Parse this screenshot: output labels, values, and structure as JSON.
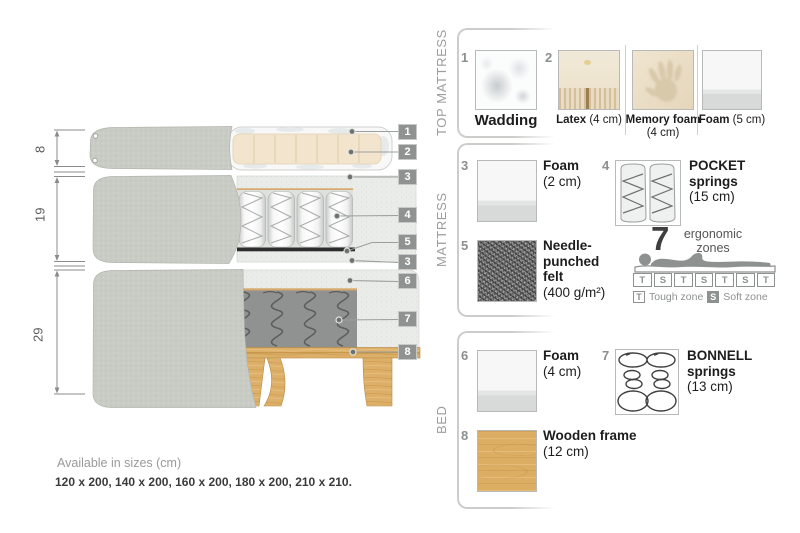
{
  "measurements": {
    "top": "8",
    "middle": "19",
    "bottom": "29"
  },
  "callouts": {
    "c1": "1",
    "c2": "2",
    "c3a": "3",
    "c4": "4",
    "c5": "5",
    "c3b": "3",
    "c6": "6",
    "c7": "7",
    "c8": "8"
  },
  "footer": {
    "title": "Available in sizes (cm)",
    "sizes": "120 x 200, 140 x 200, 160 x 200, 180 x 200, 210 x 210."
  },
  "panel": {
    "sections": {
      "top_mattress": {
        "title": "TOP MATTRESS"
      },
      "mattress": {
        "title": "MATTRESS"
      },
      "bed": {
        "title": "BED"
      }
    },
    "items": {
      "wadding": {
        "num": "1",
        "name": "Wadding",
        "size": ""
      },
      "latex": {
        "num": "2",
        "name": "Latex",
        "size": "(4 cm)"
      },
      "memory_foam": {
        "name": "Memory foam",
        "size": "(4 cm)"
      },
      "foam5": {
        "name": "Foam",
        "size": "(5 cm)"
      },
      "foam2": {
        "num": "3",
        "name": "Foam",
        "size": "(2 cm)"
      },
      "pocket": {
        "num": "4",
        "name": "POCKET springs",
        "size": "(15 cm)"
      },
      "felt": {
        "num": "5",
        "name": "Needle-punched felt",
        "size": "(400 g/m²)"
      },
      "foam4": {
        "num": "6",
        "name": "Foam",
        "size": "(4 cm)"
      },
      "bonnell": {
        "num": "7",
        "name": "BONNELL springs",
        "size": "(13 cm)"
      },
      "wood": {
        "num": "8",
        "name": "Wooden frame",
        "size": "(12 cm)"
      }
    },
    "ergonomic": {
      "count": "7",
      "label": "ergonomic zones",
      "zones": [
        "T",
        "S",
        "T",
        "S",
        "T",
        "S",
        "T"
      ],
      "tough_letter": "T",
      "tough_label": "Tough zone",
      "soft_letter": "S",
      "soft_label": "Soft zone"
    }
  },
  "colors": {
    "cover_gray": "#c9ccc5",
    "foam_light": "#eaece9",
    "latex_beige": "#f3e5cd",
    "wood_tan": "#dcae63",
    "felt_dark": "#2d2d2d",
    "badge_gray": "#8e9291"
  }
}
